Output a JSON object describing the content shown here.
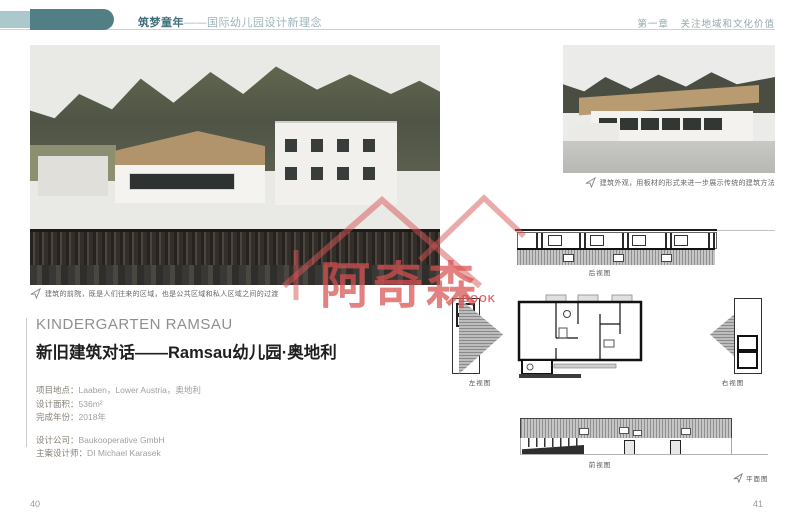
{
  "header": {
    "book_title_bold": "筑梦童年",
    "book_title_rest": "——国际幼儿园设计新理念",
    "chapter": "第一章",
    "chapter_title": "关注地域和文化价值"
  },
  "project": {
    "title_en": "KINDERGARTEN RAMSAU",
    "title_cn": "新旧建筑对话——Ramsau幼儿园·奥地利",
    "details": [
      {
        "label": "项目地点：",
        "value": "Laaben，Lower Austria，奥地利"
      },
      {
        "label": "设计面积：",
        "value": "536m²"
      },
      {
        "label": "完成年份：",
        "value": "2018年"
      },
      {
        "label": "设计公司：",
        "value": "Baukooperative GmbH"
      },
      {
        "label": "主案设计师：",
        "value": "DI Michael Karasek"
      }
    ]
  },
  "captions": {
    "main_photo": "建筑的前院，既是人们往来的区域，也是公共区域和私人区域之间的过渡",
    "side_photo": "建筑外观，用板材的形式来进一步展示传统的建筑方法"
  },
  "drawings": {
    "rear_view": "后视图",
    "left_view": "左视图",
    "right_view": "右视图",
    "front_view": "前视图",
    "plan_view": "平面图"
  },
  "watermark": {
    "brand": "阿奇森",
    "sub": "BOOK"
  },
  "page_numbers": {
    "left": "40",
    "right": "41"
  },
  "colors": {
    "accent_teal": "#527e86",
    "watermark_red": "#d85555",
    "wood": "#b59468"
  }
}
